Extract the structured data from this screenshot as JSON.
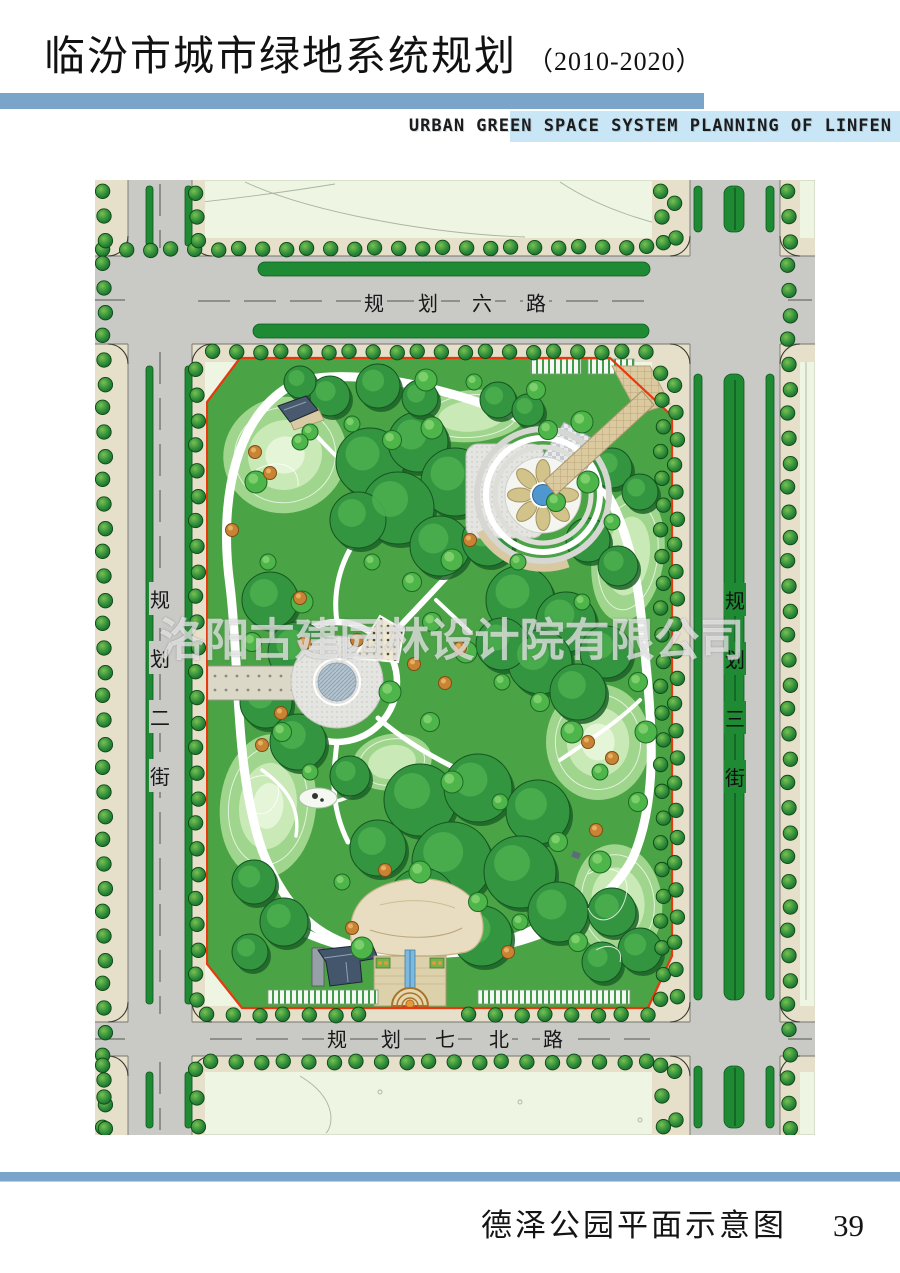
{
  "page": {
    "title_cn": "临汾市城市绿地系统规划",
    "title_period": "（2010-2020）",
    "subtitle_en": "URBAN GREEN SPACE SYSTEM PLANNING OF LINFEN",
    "caption": "德泽公园平面示意图",
    "page_number": "39"
  },
  "map": {
    "watermark": "洛阳古建园林设计院有限公司",
    "roads": {
      "north": "规划六路",
      "west": "规划二街",
      "east": "规划三街",
      "south": "规划七北路"
    }
  },
  "colors": {
    "header_bar": "#7ba4cb",
    "subtitle_band": "#c9e6f6",
    "road_gray": "#c9c9c6",
    "sidewalk_tan": "#e6dfca",
    "city_block": "#eef5e2",
    "hedge_green": "#1f8a34",
    "park_green": "#4aa344",
    "canopy_green": "#339540",
    "canopy_shadow": "#1c6128",
    "lawn_light": "#9fd58c",
    "lawn_lighter": "#c9eab6",
    "path_white": "#ffffff",
    "boundary_red": "#e8380d",
    "plaza_gray": "#e4e4e1",
    "paving_tan": "#dbc9a0",
    "water_blue": "#4f97cf",
    "street_tree": "#2e8c3c",
    "orange_tree": "#c98334",
    "roof_slate": "#44566b",
    "watermark_white": "rgba(255,255,255,0.62)"
  }
}
